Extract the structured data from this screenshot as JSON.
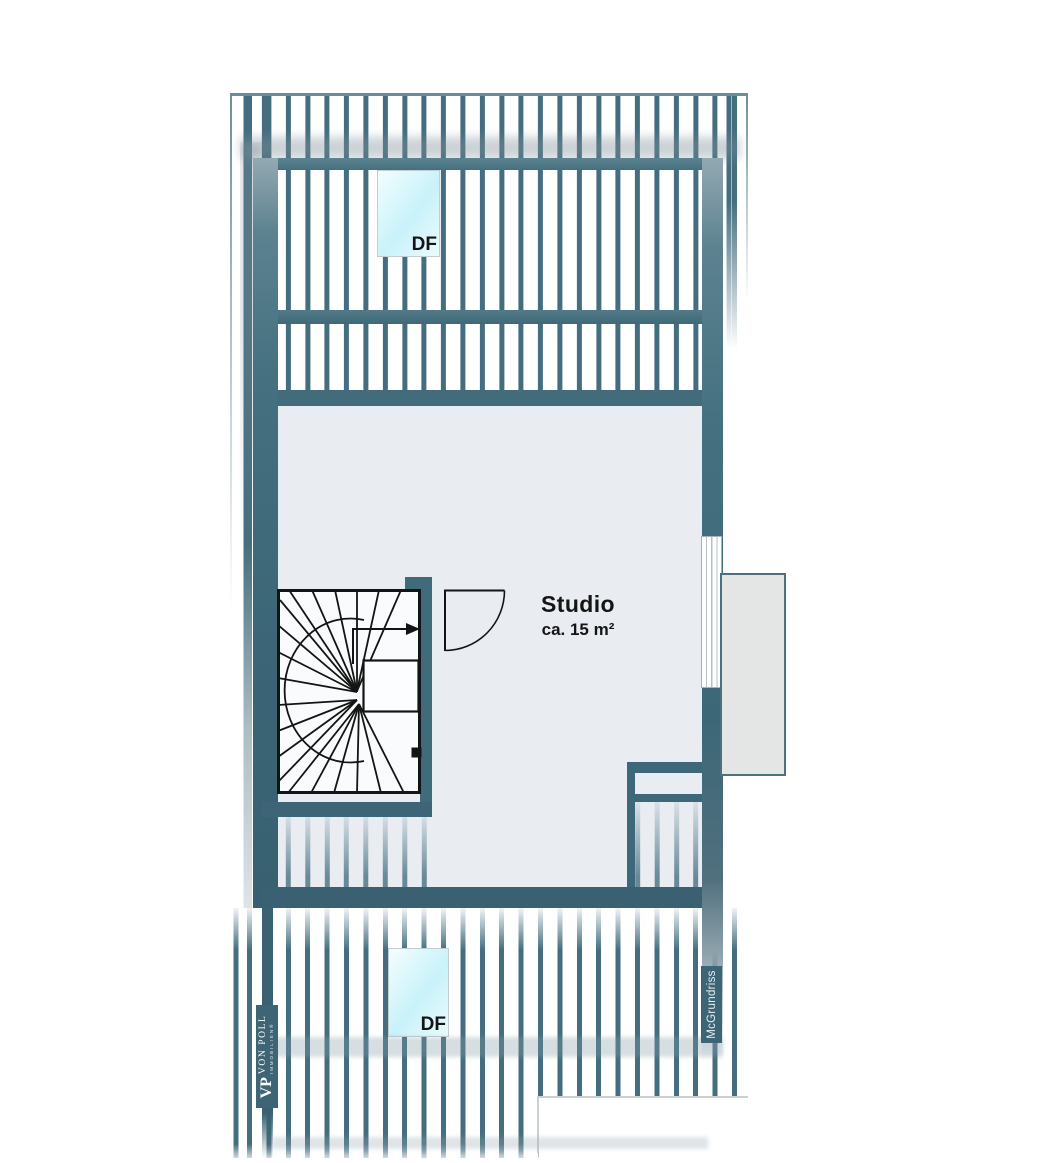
{
  "labels": {
    "room_name": "Studio",
    "room_area": "ca. 15 m²",
    "skylight_top": "DF",
    "skylight_bottom": "DF",
    "watermark": "McGrundriss"
  },
  "logo": {
    "monogram": "VP",
    "brand": "VON POLL",
    "division": "IMMOBILIEN®"
  },
  "colors": {
    "stripe": "#446e7f",
    "wall_teal": "#3e6878",
    "wall_dark": "#3a6172",
    "floor": "#e9edf2",
    "skylight_fill": "#c9f2fa",
    "balcony_fill": "#e4e6e5",
    "label_bg": "#3d6575",
    "text": "#151515"
  }
}
